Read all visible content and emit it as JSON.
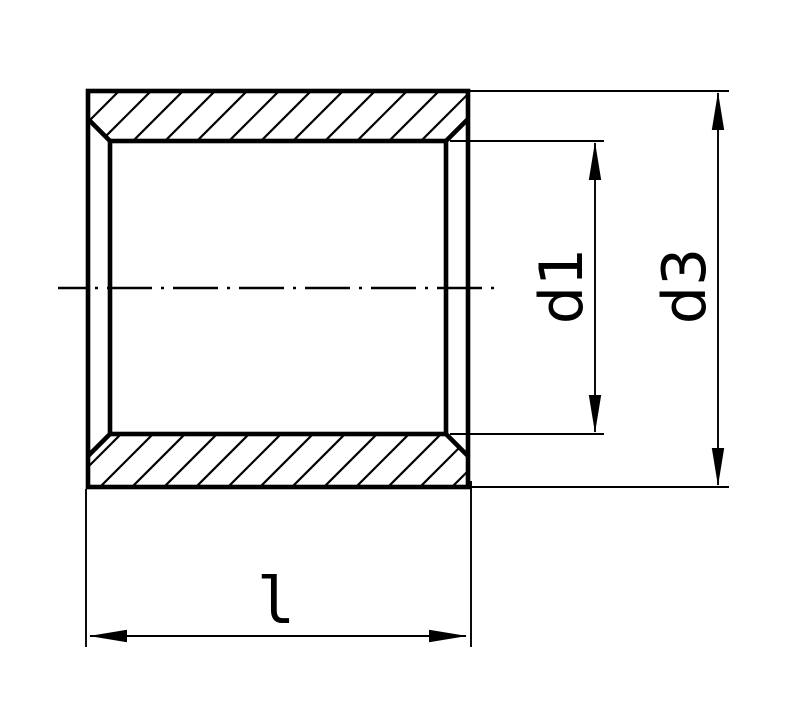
{
  "page": {
    "background": "#ffffff",
    "ink_color": "#000000"
  },
  "drawing": {
    "description": "Longitudinal section of a cylindrical bushing (sleeve) with chamfered bore, hatched cut faces, horizontal center axis and three dimensions",
    "labels": {
      "bore_diameter": "d1",
      "outer_diameter": "d3",
      "length": "l"
    }
  }
}
